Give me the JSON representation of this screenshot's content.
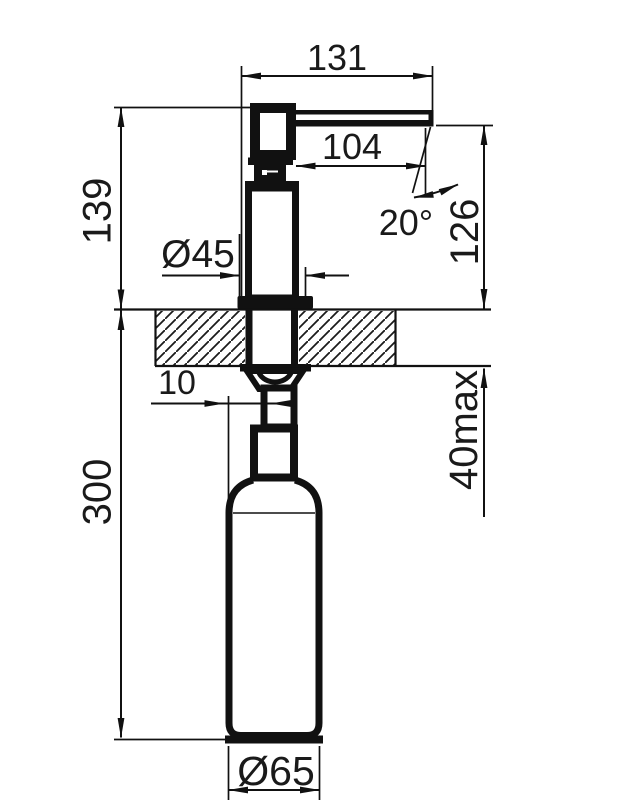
{
  "colors": {
    "line": "#111111",
    "text": "#1a1a1a",
    "background": "#ffffff"
  },
  "drawing_type": "technical-dimension-drawing",
  "dimensions": {
    "spout_overall_width": "131",
    "spout_reach": "104",
    "height_above_counter": "139",
    "flange_diameter": "Ø45",
    "spout_angle": "20°",
    "spout_outlet_height": "126",
    "edge_offset": "10",
    "under_counter_depth": "300",
    "counter_thickness_max": "40max",
    "bottle_diameter": "Ø65"
  }
}
